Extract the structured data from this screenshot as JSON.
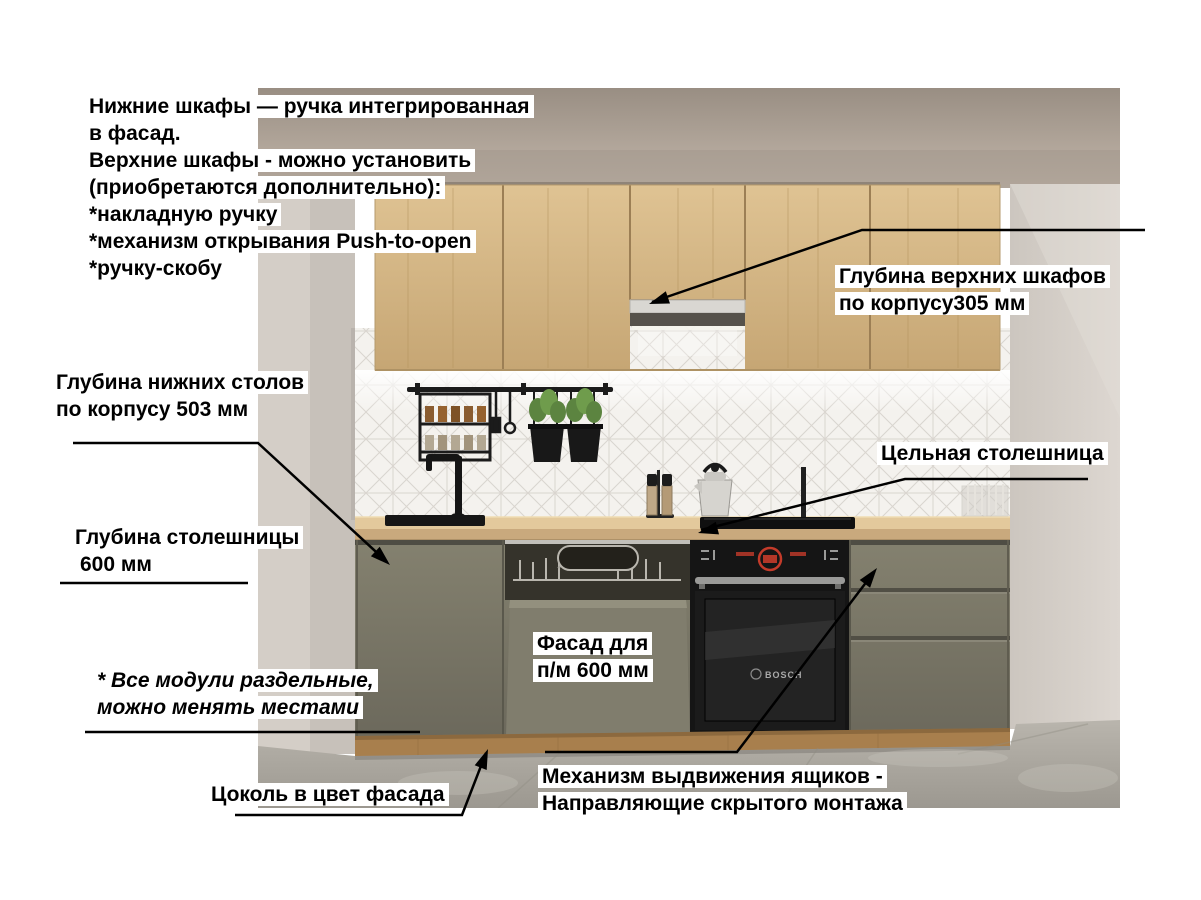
{
  "annotations": {
    "top_note": {
      "lines": [
        "Нижние шкафы — ручка интегрированная",
        "в фасад.",
        "Верхние шкафы - можно установить",
        "(приобретаются дополнительно):",
        "*накладную ручку",
        "*механизм открывания Push-to-open",
        "*ручку-скобу"
      ]
    },
    "upper_cabinet_depth": {
      "line1": "Глубина верхних шкафов",
      "line2": "по корпусу305 мм"
    },
    "base_cabinet_depth": {
      "line1": "Глубина нижних столов",
      "line2": "по корпусу 503 мм"
    },
    "solid_countertop": {
      "text": "Цельная столешница"
    },
    "countertop_depth": {
      "line1": "Глубина столешницы",
      "line2": "600 мм"
    },
    "dishwasher_facade": {
      "line1": "Фасад для",
      "line2": "п/м 600 мм"
    },
    "modules_note": {
      "line1": "* Все модули раздельные,",
      "line2": "можно менять местами"
    },
    "plinth_note": {
      "text": "Цоколь в цвет фасада"
    },
    "drawer_mechanism": {
      "line1": "Механизм выдвижения ящиков -",
      "line2": "Направляющие скрытого монтажа"
    }
  },
  "scene": {
    "oven_brand": "BOSCH",
    "colors": {
      "background": "#ffffff",
      "annotation_text": "#000000",
      "annotation_line": "#000000",
      "upper_cabinet_wood": "#d5b688",
      "base_cabinet_facade": "#7b7869",
      "countertop_wood": "#dfc494",
      "plinth_wood": "#a87f4d",
      "backsplash_tile": "#f4f2ee",
      "right_wall": "#d6d0ca",
      "floor_concrete": "#aba79f",
      "oven_black": "#151515",
      "oven_display_red": "#c43b2a"
    }
  }
}
